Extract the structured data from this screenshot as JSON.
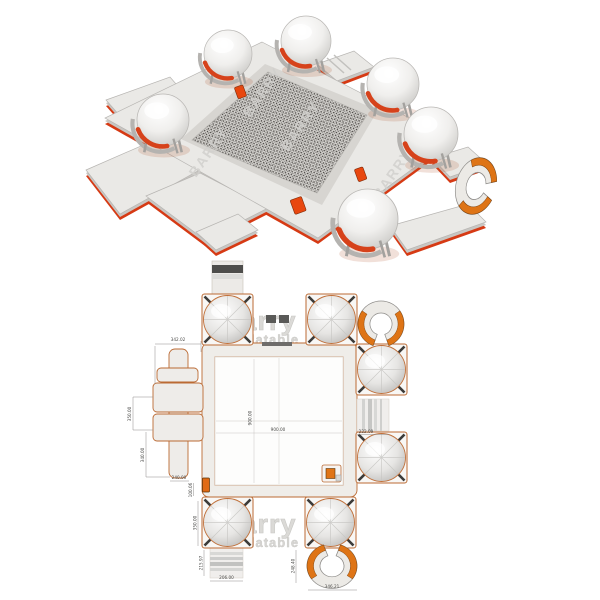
{
  "watermark": {
    "brand": "Barry",
    "sub": "Inflatable",
    "brand_caps": "BARRY"
  },
  "plan": {
    "dims": {
      "top_left": "342.02",
      "left_upper": "350.00",
      "left_lower": "340.00",
      "cross_width": "240.00",
      "edge_gap": "100.06",
      "bottom_dome": "350.00",
      "walkway_height": "215.97",
      "walkway_width": "206.00",
      "right_walkway": "222.09",
      "horseshoe_height": "248.40",
      "bottom_width": "346.21",
      "pool_width": "900.00",
      "pool_height": "900.00"
    }
  },
  "colors": {
    "accent_orange": "#e0731a",
    "underside_red": "#d63a14",
    "outline_orange": "#bb6a33",
    "deck_gray": "#e9e8e5",
    "mesh_dark": "#45423f",
    "watermark_gray": "#d8d7d4",
    "dim_text": "#4a4a48"
  }
}
